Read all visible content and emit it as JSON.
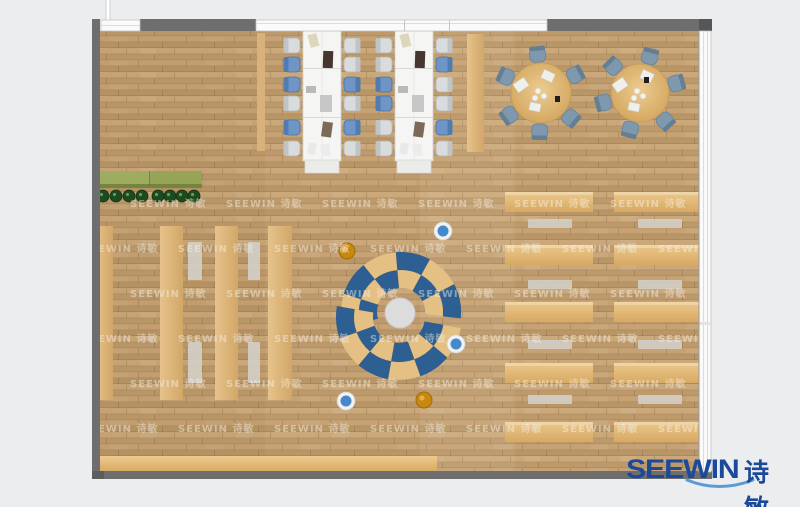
{
  "watermark": {
    "text": "SEEWIN 诗敏"
  },
  "logo": {
    "brand": "SEEWIN",
    "brand_cn": "诗敏"
  },
  "colors": {
    "background": "#ecedee",
    "wall_gray": "#6e6e6e",
    "window_white": "#fafafa",
    "floor_base": "#c3a073",
    "shelf_tan": "#dfb983",
    "desk_tan": "#dfb470",
    "bench_gray": "#d3cec6",
    "table_white": "#f5f5f4",
    "chair_gray": "#d9dbdd",
    "chair_blue": "#6e95c6",
    "round_chair_slate": "#7e99ae",
    "round_table_tan": "#ddb06a",
    "arc_blue": "#2d5f92",
    "arc_tan": "#e5c084",
    "pouf_blue": "#4489cc",
    "pouf_orange": "#c8880f",
    "planter_green": "#96a458",
    "plant_dark_green": "#1d4a20",
    "center_circle_gray": "#dcdcdc",
    "logo_blue": "#1b4a9b",
    "logo_swoosh": "#5a9bd5"
  },
  "furniture": {
    "chair_rows_y": [
      38,
      57,
      77,
      96,
      120,
      141
    ],
    "long_tables": [
      {
        "x": 303,
        "chair_cols": [
          {
            "x": 285,
            "side": "left",
            "colors": [
              "gray",
              "blue",
              "blue",
              "gray",
              "blue",
              "gray"
            ]
          },
          {
            "x": 344,
            "side": "right",
            "colors": [
              "gray",
              "gray",
              "blue",
              "gray",
              "blue",
              "gray"
            ]
          }
        ]
      },
      {
        "x": 395,
        "chair_cols": [
          {
            "x": 377,
            "side": "left",
            "colors": [
              "gray",
              "gray",
              "blue",
              "blue",
              "gray",
              "gray"
            ]
          },
          {
            "x": 436,
            "side": "right",
            "colors": [
              "gray",
              "blue",
              "gray",
              "gray",
              "blue",
              "gray"
            ]
          }
        ]
      }
    ],
    "long_table_items": [
      {
        "x": 309,
        "y": 34,
        "w": 9,
        "h": 13,
        "rot": -14,
        "c": "#ddd6bd"
      },
      {
        "x": 323,
        "y": 51,
        "w": 10,
        "h": 17,
        "rot": 2,
        "c": "#463630"
      },
      {
        "x": 306,
        "y": 86,
        "w": 10,
        "h": 7,
        "rot": 0,
        "c": "#b9b9b9"
      },
      {
        "x": 320,
        "y": 95,
        "w": 12,
        "h": 17,
        "rot": 0,
        "c": "#c7c7c7"
      },
      {
        "x": 322,
        "y": 122,
        "w": 10,
        "h": 15,
        "rot": 8,
        "c": "#7b6a55"
      },
      {
        "x": 308,
        "y": 143,
        "w": 8,
        "h": 11,
        "rot": 10,
        "c": "#e9e9e9"
      },
      {
        "x": 321,
        "y": 144,
        "w": 9,
        "h": 12,
        "rot": -8,
        "c": "#ececec"
      }
    ],
    "long_table_dx": [
      0,
      92
    ],
    "round_tables": [
      {
        "cx": 541,
        "cy": 93,
        "r": 30,
        "chair_angles": [
          95,
          155,
          215,
          268,
          320,
          28
        ],
        "dark_dx": 14,
        "dark_dy": 3
      },
      {
        "cx": 640,
        "cy": 93,
        "r": 29,
        "chair_angles": [
          75,
          135,
          195,
          255,
          312,
          15
        ],
        "dark_dx": 4,
        "dark_dy": -16
      }
    ],
    "round_table_papers": [
      {
        "dx": -20,
        "dy": -8,
        "w": 13,
        "h": 10,
        "rot": -35
      },
      {
        "dx": 7,
        "dy": -17,
        "w": 12,
        "h": 9,
        "rot": 25
      },
      {
        "dx": -6,
        "dy": 14,
        "w": 11,
        "h": 8,
        "rot": 12
      }
    ],
    "arcs": [
      {
        "cx": 401,
        "cy": 312,
        "r_inner": [
          24,
          42
        ],
        "r_outer": [
          42,
          60
        ],
        "start": -6,
        "end": 196,
        "segments": 6
      },
      {
        "cx": 399,
        "cy": 317,
        "r_inner": [
          26,
          45
        ],
        "r_outer": [
          45,
          63
        ],
        "start": 170,
        "end": 350,
        "segments": 6
      }
    ],
    "center_circle": {
      "cx": 400,
      "cy": 313,
      "r": 15
    },
    "poufs": [
      {
        "cx": 443,
        "cy": 231,
        "type": "blue"
      },
      {
        "cx": 456,
        "cy": 344,
        "type": "blue"
      },
      {
        "cx": 346,
        "cy": 401,
        "type": "blue"
      },
      {
        "cx": 347,
        "cy": 251,
        "type": "orange"
      },
      {
        "cx": 424,
        "cy": 400,
        "type": "orange"
      }
    ],
    "plants_x": [
      103,
      116,
      129,
      142,
      158,
      170,
      182,
      194
    ],
    "plants_y": 196,
    "left_strips": [
      {
        "x": 95,
        "w": 18
      },
      {
        "x": 160,
        "w": 23
      },
      {
        "x": 215,
        "w": 23
      },
      {
        "x": 268,
        "w": 24
      }
    ],
    "left_strips_y": 226,
    "left_strips_h": 174,
    "left_benches": [
      {
        "x": 188,
        "y": 242,
        "w": 14,
        "h": 38
      },
      {
        "x": 248,
        "y": 242,
        "w": 12,
        "h": 38
      },
      {
        "x": 188,
        "y": 342,
        "w": 14,
        "h": 41
      },
      {
        "x": 248,
        "y": 342,
        "w": 12,
        "h": 41
      }
    ],
    "desk_rows_y": [
      192,
      245,
      302,
      363,
      422
    ],
    "desk_cols": [
      {
        "x": 505,
        "w": 88
      },
      {
        "x": 614,
        "w": 85
      }
    ],
    "desk_h": 20,
    "bench_rows_y": [
      219,
      280,
      340,
      395
    ],
    "bench_cols_x": [
      528,
      638
    ],
    "bench_w": 44,
    "bench_h": 9
  }
}
